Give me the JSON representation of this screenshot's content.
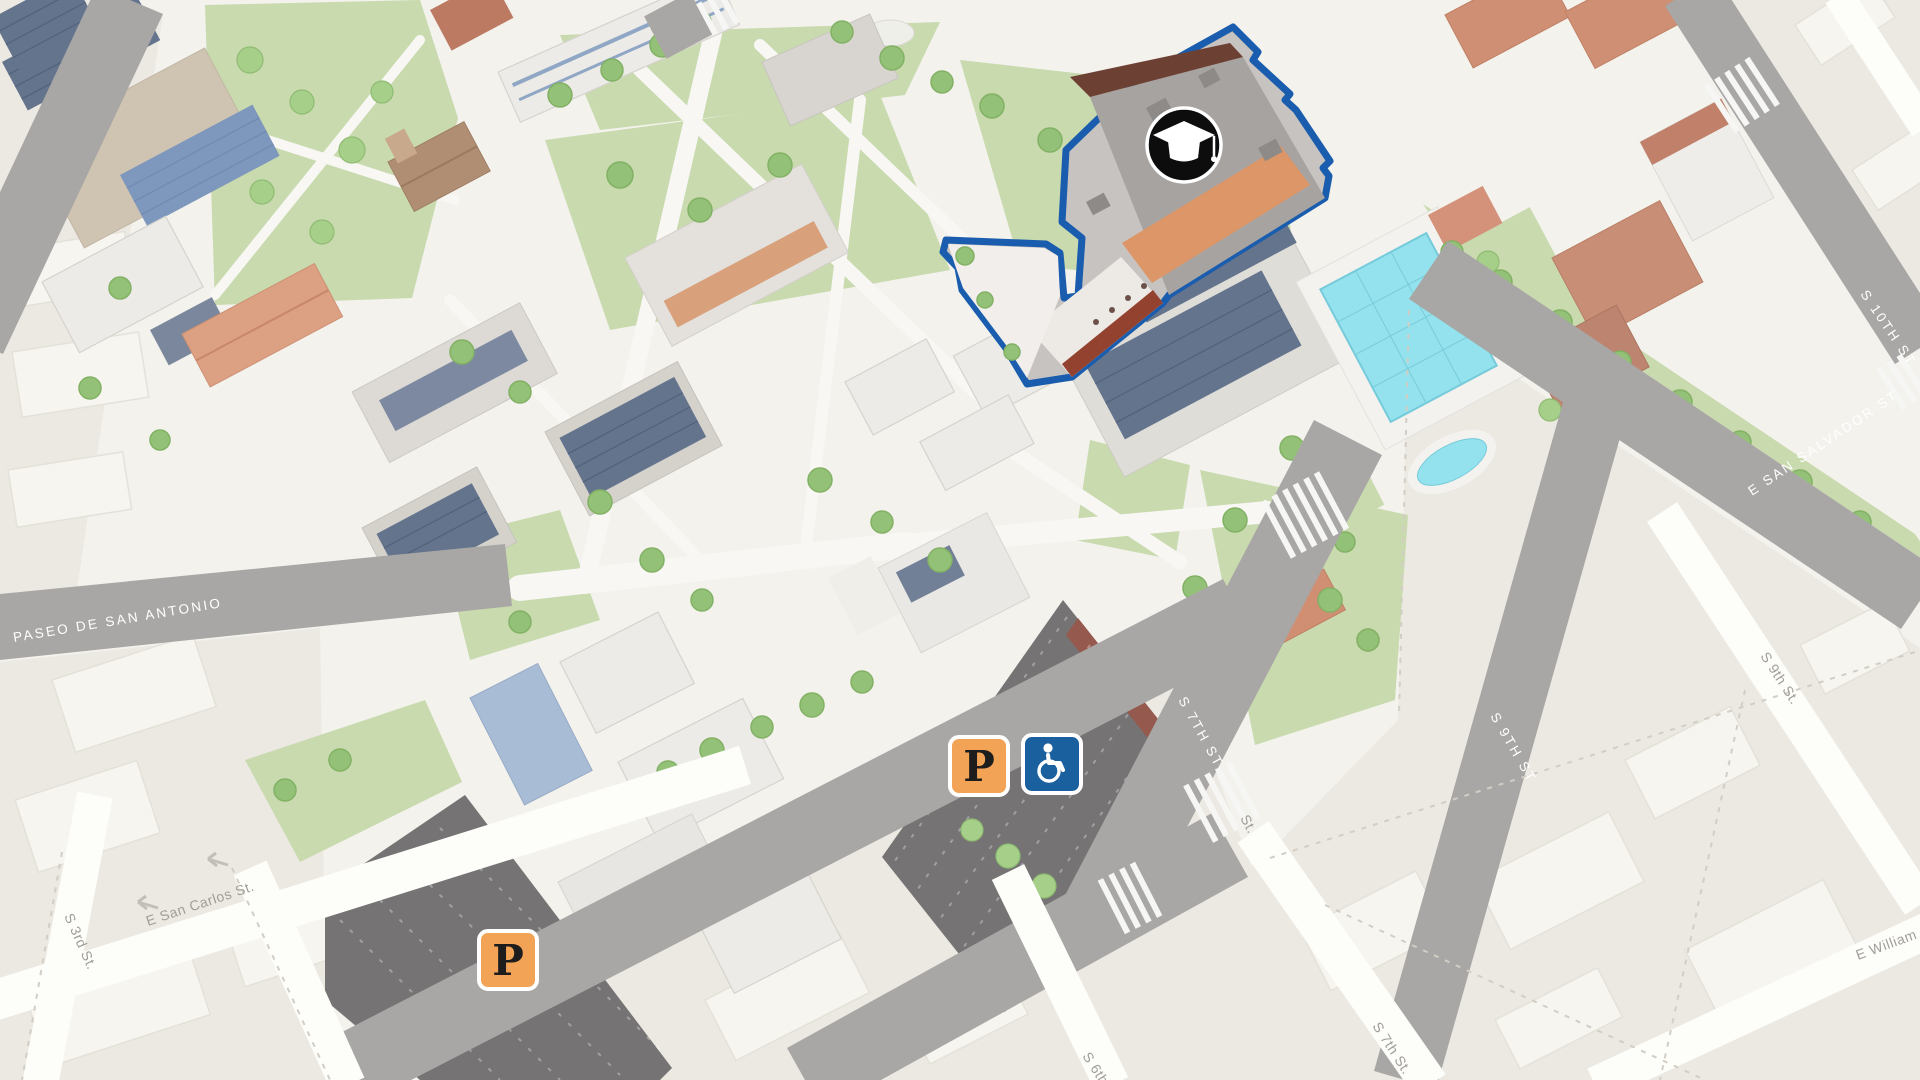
{
  "map": {
    "kind": "isometric campus map",
    "streets": {
      "paseo_de_san_antonio": "PASEO DE SAN ANTONIO",
      "s_7th_st_campus": "S 7TH ST",
      "s_9th_st_campus": "S 9TH ST",
      "s_10th_st": "S 10TH ST",
      "e_san_salvador_st": "E SAN SALVADOR ST",
      "e_san_carlos_st": "E San Carlos St.",
      "s_3rd_st": "S 3rd St.",
      "s_9th_st": "S 9th St.",
      "s_7th_st": "S 7th St.",
      "s_6th_st": "S 6th St.",
      "st_partial": "St.",
      "e_william_st": "E William St."
    },
    "markers": {
      "parking_label": "P",
      "accessible_icon": "wheelchair",
      "building_icon": "graduation-cap"
    },
    "colors": {
      "highlight_outline": "#1A5CAD",
      "parking_orange": "#F2A355",
      "accessible_blue": "#1A5F9E",
      "marker_black": "#0D0D0D",
      "road_gray": "#A8A7A5",
      "offcampus_beige": "#ECE9E2",
      "pool_cyan": "#93E2EE"
    }
  }
}
